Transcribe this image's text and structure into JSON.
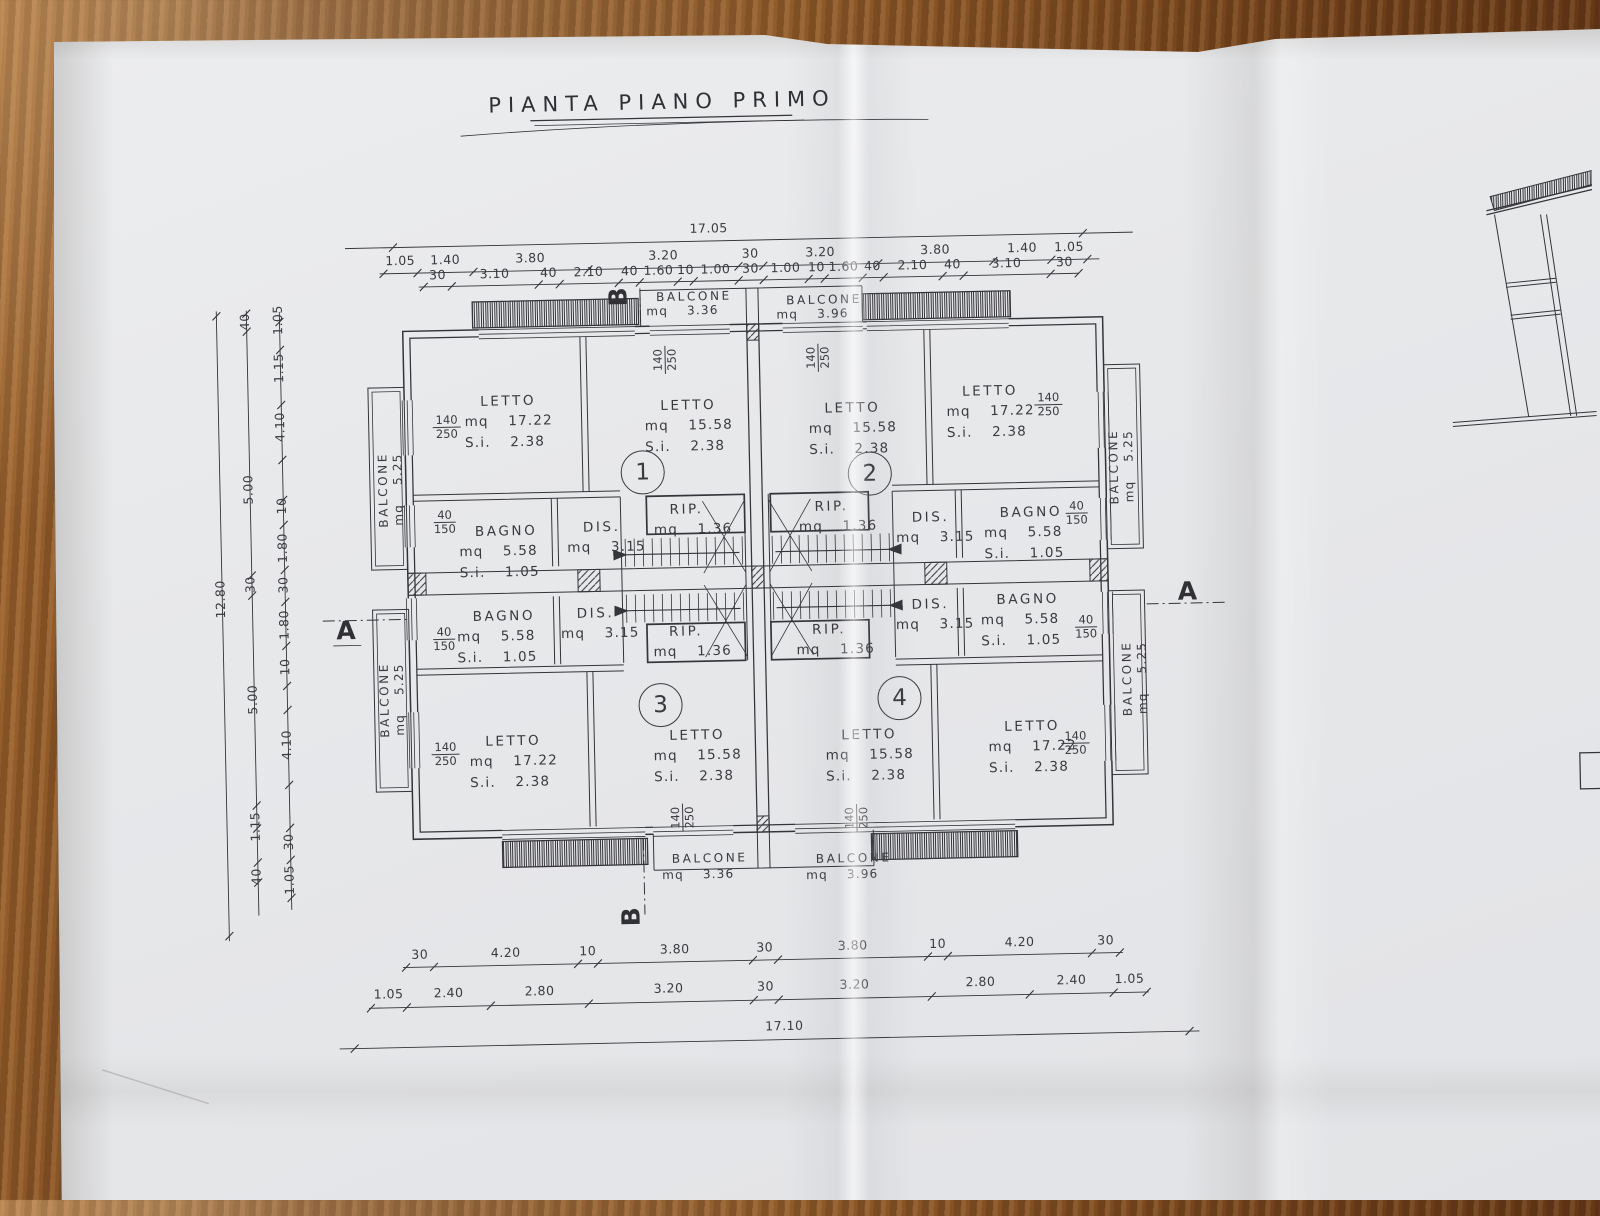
{
  "title": "PIANTA PIANO PRIMO",
  "colors": {
    "paper": "#e7e8ea",
    "ink": "#34343a",
    "wood": "#8a5426"
  },
  "sections": {
    "a": "A",
    "b": "B"
  },
  "apartments": {
    "n1": "1",
    "n2": "2",
    "n3": "3",
    "n4": "4"
  },
  "windows": {
    "w140": "140",
    "w250": "250",
    "w40": "40",
    "w150": "150"
  },
  "rooms": {
    "tl_a": {
      "l1": "LETTO",
      "l2": "mq 17.22",
      "l3": "S.i. 2.38"
    },
    "tl_b": {
      "l1": "LETTO",
      "l2": "mq 15.58",
      "l3": "S.i. 2.38"
    },
    "tr_a": {
      "l1": "LETTO",
      "l2": "mq 15.58",
      "l3": "S.i. 2.38"
    },
    "tr_b": {
      "l1": "LETTO",
      "l2": "mq 17.22",
      "l3": "S.i. 2.38"
    },
    "bl_a": {
      "l1": "LETTO",
      "l2": "mq 17.22",
      "l3": "S.i. 2.38"
    },
    "bl_b": {
      "l1": "LETTO",
      "l2": "mq 15.58",
      "l3": "S.i. 2.38"
    },
    "br_a": {
      "l1": "LETTO",
      "l2": "mq 15.58",
      "l3": "S.i. 2.38"
    },
    "br_b": {
      "l1": "LETTO",
      "l2": "mq 17.22",
      "l3": "S.i. 2.38"
    },
    "bagno_lt": {
      "l1": "BAGNO",
      "l2": "mq 5.58",
      "l3": "S.i. 1.05"
    },
    "bagno_lb": {
      "l1": "BAGNO",
      "l2": "mq 5.58",
      "l3": "S.i. 1.05"
    },
    "bagno_rt": {
      "l1": "BAGNO",
      "l2": "mq 5.58",
      "l3": "S.i. 1.05"
    },
    "bagno_rb": {
      "l1": "BAGNO",
      "l2": "mq 5.58",
      "l3": "S.i. 1.05"
    },
    "dis_lt": {
      "l1": "DIS.",
      "l2": "mq 3.15"
    },
    "dis_lb": {
      "l1": "DIS.",
      "l2": "mq 3.15"
    },
    "dis_rt": {
      "l1": "DIS.",
      "l2": "mq 3.15"
    },
    "dis_rb": {
      "l1": "DIS.",
      "l2": "mq 3.15"
    },
    "rip_tl": {
      "l1": "RIP.",
      "l2": "mq 1.36"
    },
    "rip_tr": {
      "l1": "RIP.",
      "l2": "mq 1.36"
    },
    "rip_bl": {
      "l1": "RIP.",
      "l2": "mq 1.36"
    },
    "rip_br": {
      "l1": "RIP.",
      "l2": "mq 1.36"
    },
    "balc_top_l": {
      "l1": "BALCONE",
      "l2": "mq 3.36"
    },
    "balc_top_r": {
      "l1": "BALCONE",
      "l2": "mq 3.96"
    },
    "balc_bot_l": {
      "l1": "BALCONE",
      "l2": "mq 3.36"
    },
    "balc_bot_r": {
      "l1": "BALCONE",
      "l2": "mq 3.96"
    },
    "balc_side_lt": {
      "l1": "BALCONE",
      "l2": "mq 5.25"
    },
    "balc_side_lb": {
      "l1": "BALCONE",
      "l2": "mq 5.25"
    },
    "balc_side_rt": {
      "l1": "BALCONE",
      "l2": "mq 5.25"
    },
    "balc_side_rb": {
      "l1": "BALCONE",
      "l2": "mq 5.25"
    }
  },
  "dims": {
    "top_overall": "17.05",
    "top2": [
      "1.05",
      "1.40",
      "3.80",
      "3.20",
      "30",
      "3.20",
      "3.80",
      "1.40",
      "1.05"
    ],
    "top3": [
      "30",
      "3.10",
      "40",
      "2.10",
      "40",
      "1.60",
      "10",
      "1.00",
      "30",
      "1.00",
      "10",
      "1.60",
      "40",
      "2.10",
      "40",
      "3.10",
      "30"
    ],
    "bottom1": [
      "30",
      "4.20",
      "10",
      "3.80",
      "30",
      "3.80",
      "10",
      "4.20",
      "30"
    ],
    "bottom2": [
      "1.05",
      "2.40",
      "2.80",
      "3.20",
      "30",
      "3.20",
      "2.80",
      "2.40",
      "1.05"
    ],
    "bottom_overall": "17.10",
    "left_overall": "12.80",
    "left_mid": [
      "40",
      "5.00",
      "30",
      "5.00",
      "1.15",
      "40"
    ],
    "left_in": [
      "1.05",
      "1.15",
      "4.10",
      "10",
      "1.80",
      "30",
      "1.80",
      "10",
      "4.10",
      "30",
      "1.05"
    ]
  }
}
